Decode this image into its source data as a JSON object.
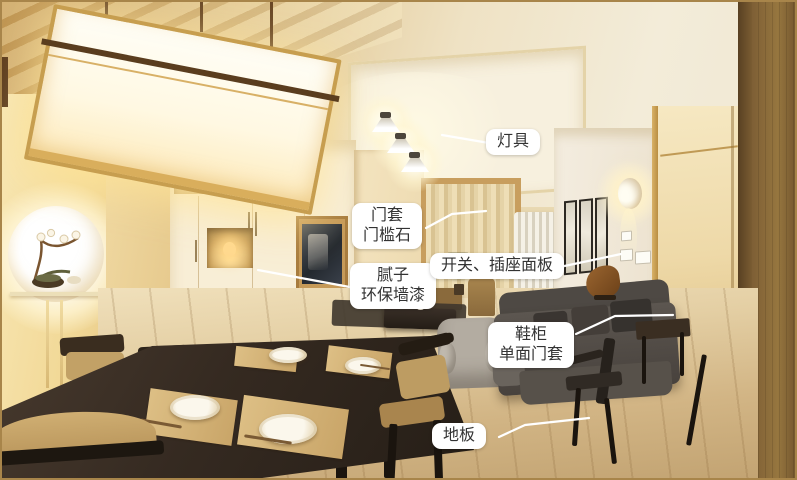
{
  "colors": {
    "border": "#a8854a",
    "label_bg": "#ffffff",
    "label_text": "#333333",
    "leader_line": "#ffffff"
  },
  "annotations": {
    "lighting": {
      "label": "灯具"
    },
    "door_casing": {
      "line1": "门套",
      "line2": "门槛石"
    },
    "wall_paint": {
      "line1": "腻子",
      "line2": "环保墙漆"
    },
    "switch_socket": {
      "label": "开关、插座面板"
    },
    "shoe_cabinet": {
      "line1": "鞋柜",
      "line2": "单面门套"
    },
    "floor": {
      "label": "地板"
    }
  }
}
